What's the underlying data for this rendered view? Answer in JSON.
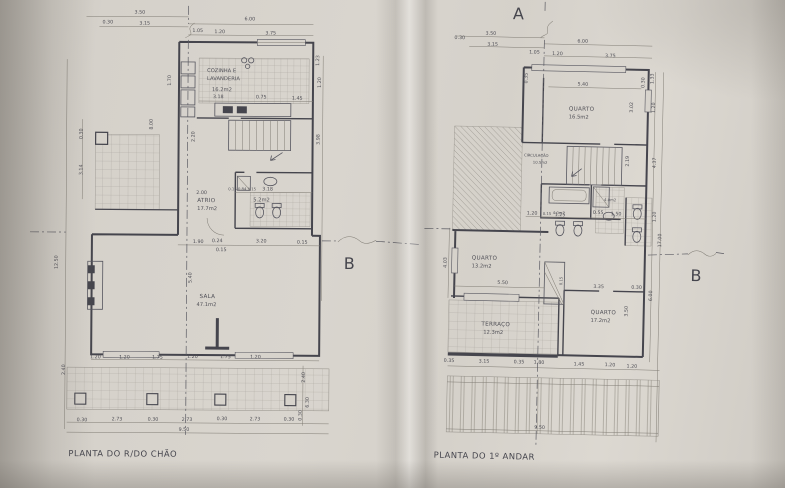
{
  "photo": {
    "description": "photograph of folded architectural blueprint sheet with two floor plans",
    "paper_color": "#d7d3cc",
    "ink_color": "#42424b",
    "shadow_color": "#a9a49d"
  },
  "lp": {
    "caption": "PLANTA DO R/DO CHÃO",
    "section_b": "B",
    "rooms": {
      "cozinha1": "COZINHA E",
      "cozinha2": "LAVANDERIA",
      "cozinha_area": "16.2m2",
      "atrio": "ATRIO",
      "atrio_area": "17.7m2",
      "wc_area": "5.2m2",
      "sala": "SALA",
      "sala_area": "47.1m2"
    },
    "dims": {
      "top1": [
        "3.50",
        "6.00"
      ],
      "top2": [
        "0.30",
        "3.15",
        "1.05",
        "1.20",
        "3.75"
      ],
      "kitchen": [
        "3.18",
        "0.75",
        "1.45"
      ],
      "wc": [
        "0.15 0.84 0.15",
        "3.18",
        "2.00"
      ],
      "entry": [
        "1.90",
        "0.24",
        "3.20",
        "0.15",
        "0.15"
      ],
      "sala_row": [
        "1.20",
        "1.20",
        "1.75",
        "1.20",
        "1.75",
        "1.20"
      ],
      "terrace": [
        "0.30",
        "2.73",
        "0.30",
        "2.73",
        "0.30",
        "2.73",
        "0.30"
      ],
      "total": "9.50",
      "left_col": [
        "12.50",
        "2.40",
        "0.30",
        "3.14",
        "8.00",
        "1.70"
      ],
      "right_col": [
        "1.23",
        "1.20",
        "2.20",
        "3.98",
        "5.40",
        "2.40",
        "6.30",
        "0.30"
      ]
    }
  },
  "rp": {
    "caption": "PLANTA DO 1º ANDAR",
    "section_a": "A",
    "section_b": "B",
    "rooms": {
      "quarto1": "QUARTO",
      "quarto1_area": "16.5m2",
      "circ": "CIRCULAÇÃO",
      "circ_area": "10.5m2",
      "wc1_area": "4.0m2",
      "wc2_area": "4.0m2",
      "quarto2": "QUARTO",
      "quarto2_area": "13.2m2",
      "terraco": "TERRAÇO",
      "terraco_area": "12.3m2",
      "quarto3": "QUARTO",
      "quarto3_area": "17.2m2"
    },
    "dims": {
      "top1": [
        "3.50",
        "6.00"
      ],
      "top2": [
        "0.30",
        "3.15",
        "1.05",
        "1.20",
        "3.75"
      ],
      "inner_top": [
        "0.35",
        "5.40",
        "0.30"
      ],
      "mid": [
        "1.20",
        "0.15",
        "1.25",
        "0.55",
        "1.50"
      ],
      "q13_width": "5.50",
      "closet": "0.15",
      "q3_top": [
        "3.35",
        "0.30"
      ],
      "bottom": [
        "0.35",
        "3.15",
        "0.35",
        "1.80",
        "1.45",
        "1.20",
        "1.20"
      ],
      "total": "9.50",
      "right_col": [
        "1.33",
        "3.02",
        "1.20",
        "2.19",
        "4.37",
        "1.20",
        "17.00",
        "6.00",
        "3.50"
      ],
      "left_col": [
        "4.03"
      ]
    }
  }
}
